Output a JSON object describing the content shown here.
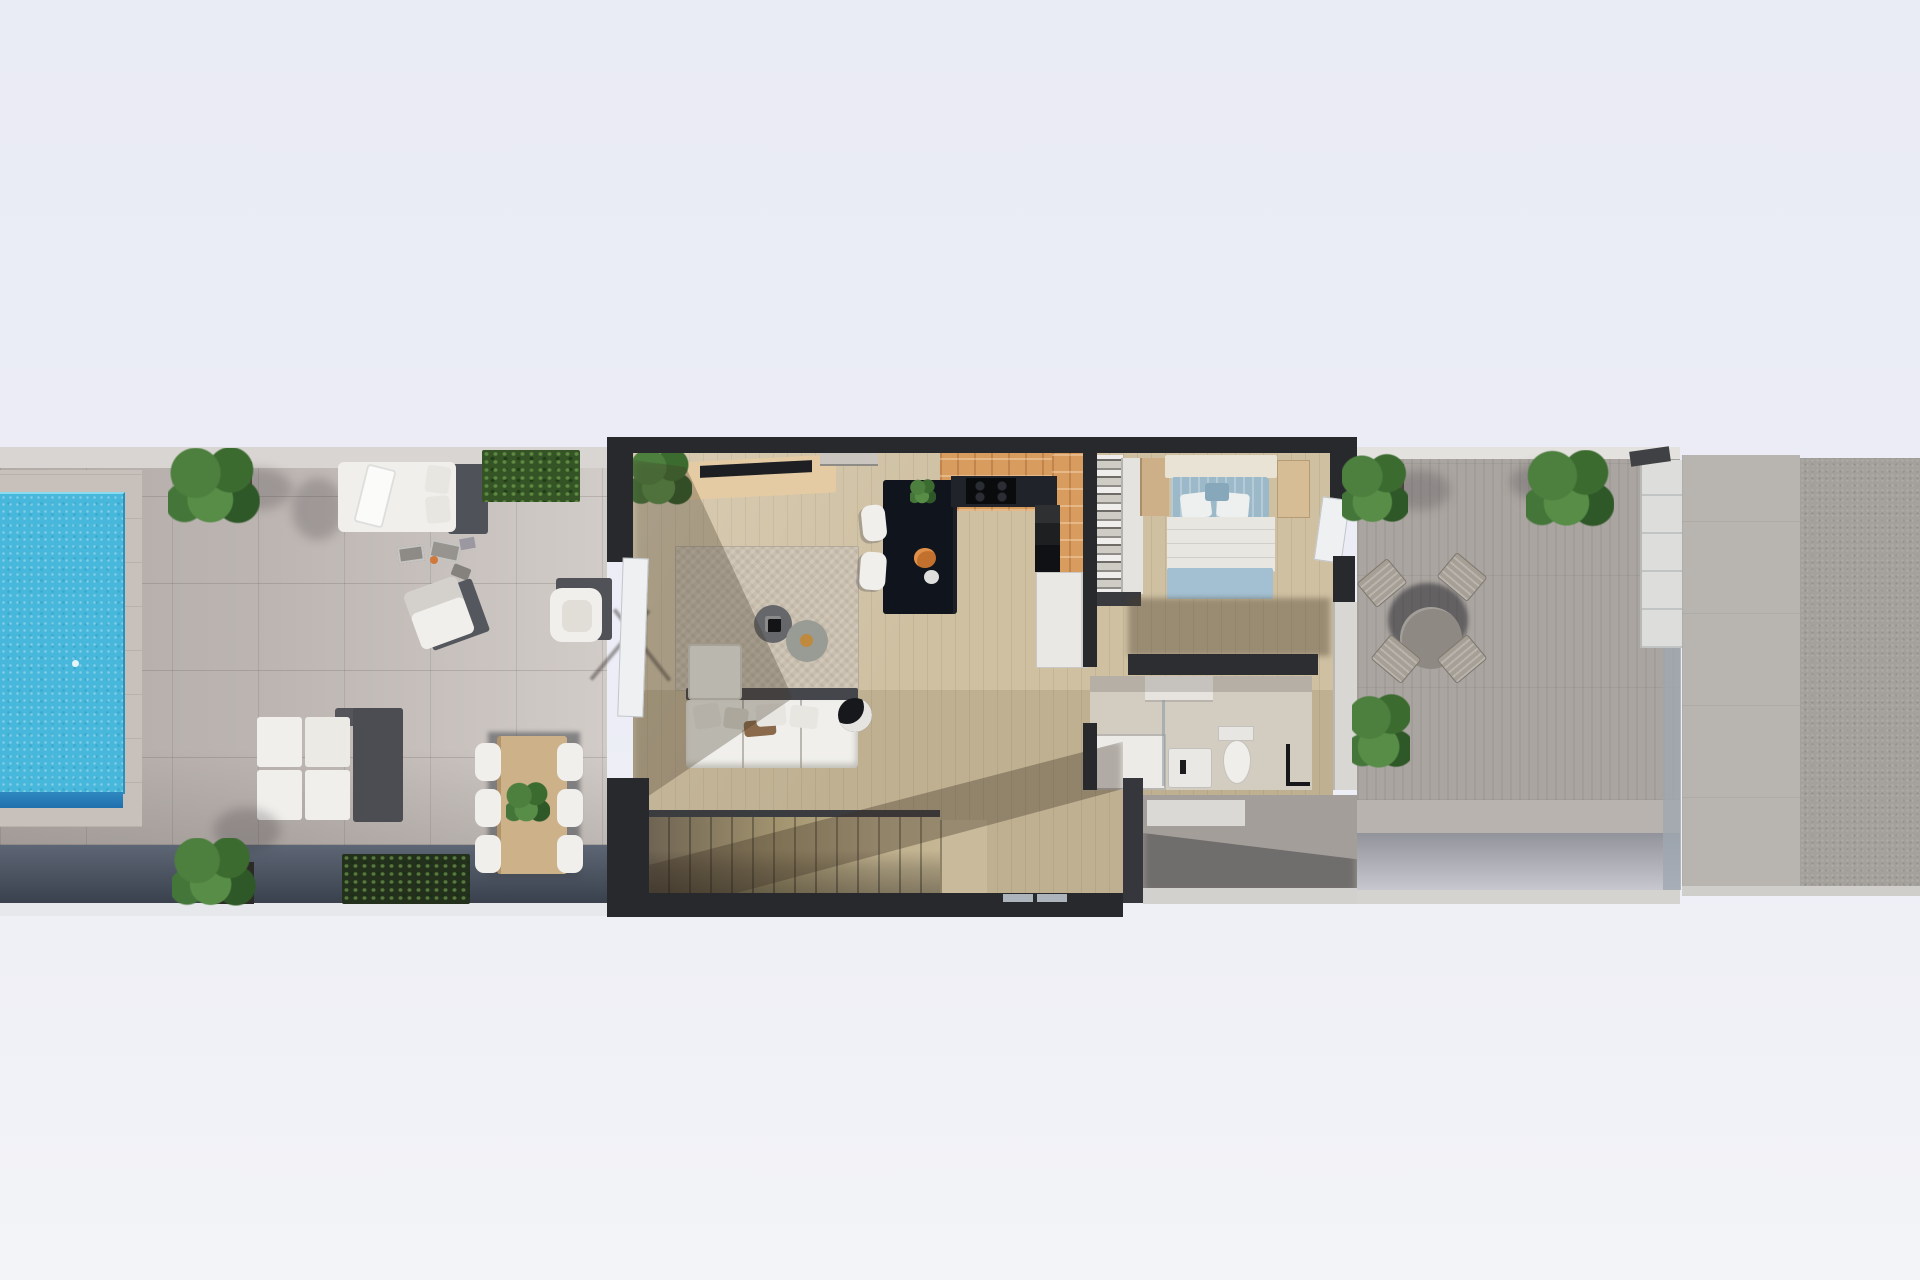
{
  "scene": {
    "title": "top-down 3d floor plan rendering",
    "view": "plan top view, single storey strip with pool terrace, interior and rear terraces",
    "visible_text": "none"
  },
  "palette": {
    "background": "#ebedf6",
    "wall_dark": "#28292d",
    "terrace_left_floor": "#bcb5b1",
    "terrace_right_floor": "#aaa5a0",
    "neighbour_band_light": "#b8b5b1",
    "neighbour_band_dark": "#a4a19c",
    "boundary_wall": "#4a5260",
    "pool_water": "#47b8db",
    "pool_deep": "#1f6fad",
    "wood_floor": "#cfc0a2",
    "kitchen_tile": "#d89c5f",
    "island": "#10141d",
    "rug": "#c9bfaf",
    "upholstery_white": "#f0efeb",
    "bed_blue": "#9cb9c9",
    "plant_green": "#4d7f3e",
    "table_wood": "#cdb189"
  },
  "areas": {
    "pool_terrace": {
      "label": "pool terrace",
      "items": [
        "swimming pool",
        "potted plant",
        "daybed",
        "hedge planter",
        "sun lounger",
        "pool accessories",
        "armchair",
        "modular lounge set",
        "outdoor dining table",
        "dining chairs",
        "boundary planters"
      ],
      "dining_chairs": 6
    },
    "living_room": {
      "label": "living room",
      "items": [
        "corner plant",
        "sideboard with tv",
        "area rug",
        "round coffee tables",
        "corner sofa",
        "floor lamp",
        "sliding door"
      ],
      "coffee_tables": 2
    },
    "kitchen": {
      "label": "kitchen",
      "items": [
        "island",
        "bar stools",
        "cooktop counter",
        "oven column",
        "fridge",
        "pantry shelving"
      ],
      "bar_stools": 2
    },
    "bedroom": {
      "label": "bedroom",
      "items": [
        "wardrobe",
        "double bed",
        "bedside bench",
        "terrace door"
      ]
    },
    "bathroom": {
      "label": "bathroom",
      "items": [
        "shower tray",
        "washbasin",
        "toilet",
        "towel stand",
        "vanity"
      ]
    },
    "hallway_stairs": {
      "label": "hall and staircase",
      "stair_treads": 15
    },
    "rear_patio": {
      "label": "rear patio",
      "items": [
        "ledge wall"
      ]
    },
    "rear_terrace": {
      "label": "rear terrace",
      "items": [
        "round dining table",
        "chairs",
        "potted plants",
        "glass railing"
      ],
      "chairs": 4
    },
    "neighbour_roofs": {
      "label": "adjacent roof terraces"
    }
  }
}
